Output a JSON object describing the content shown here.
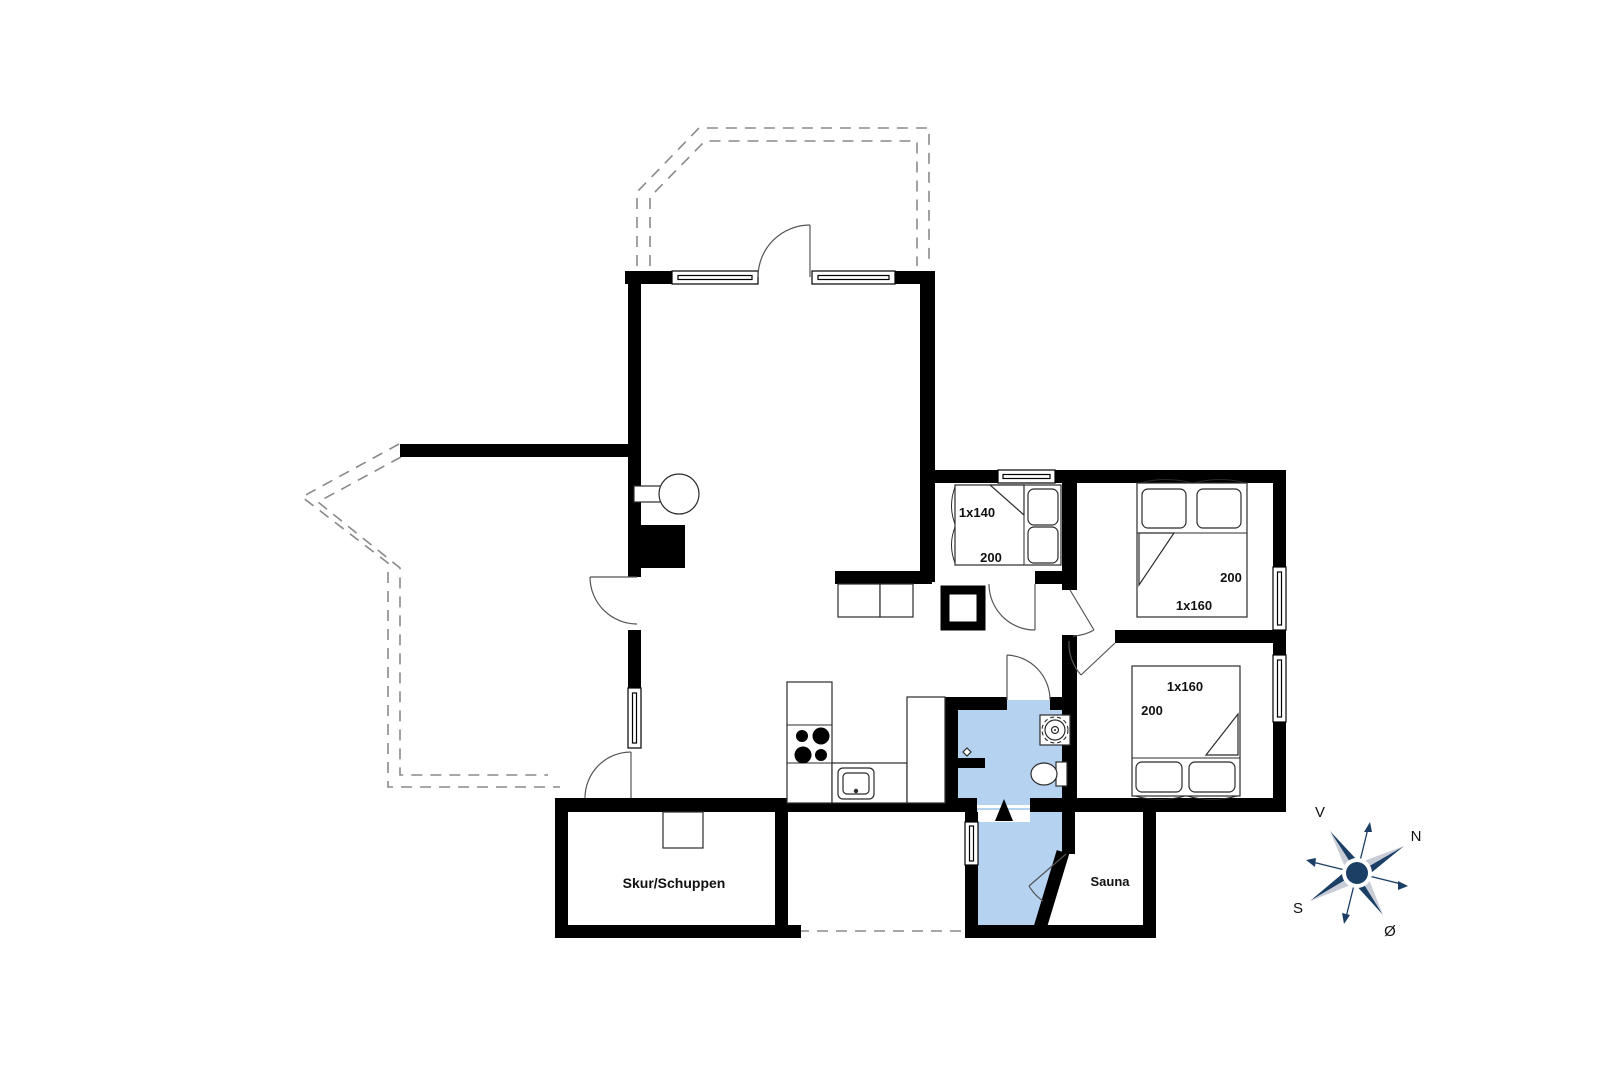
{
  "plan": {
    "rooms": {
      "shed": "Skur/Schuppen",
      "sauna": "Sauna"
    },
    "beds": {
      "small": {
        "size": "1x140",
        "length": "200"
      },
      "north": {
        "size": "1x160",
        "length": "200"
      },
      "south": {
        "size": "1x160",
        "length": "200"
      }
    },
    "compass": {
      "west": "V",
      "north": "N",
      "south": "S",
      "east": "Ø"
    },
    "colors": {
      "wet_room_highlight": "#b5d2f1",
      "compass_navy": "#1c3f66",
      "compass_light": "#c7ccd6",
      "wall_black": "#000000"
    }
  }
}
